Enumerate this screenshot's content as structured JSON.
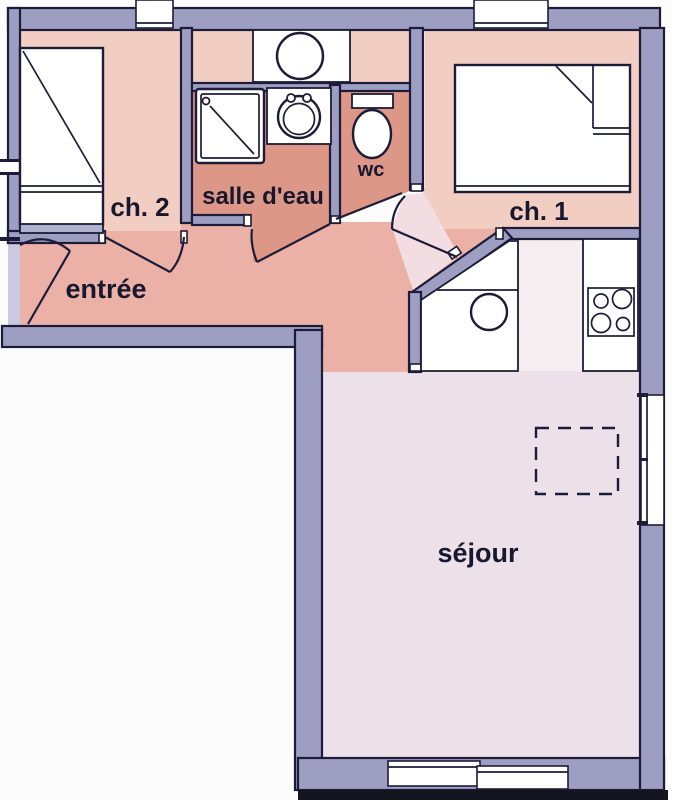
{
  "title": "Plan d'appartement (apartment floor plan)",
  "rooms": [
    {
      "id": "ch2",
      "label": "ch. 2"
    },
    {
      "id": "salle_deau",
      "label": "salle d'eau"
    },
    {
      "id": "wc",
      "label": "wc"
    },
    {
      "id": "ch1",
      "label": "ch. 1"
    },
    {
      "id": "entree",
      "label": "entrée"
    },
    {
      "id": "sejour",
      "label": "séjour"
    }
  ],
  "fixtures": [
    "single-bed",
    "double-bed",
    "shower",
    "washbasin",
    "round-appliance-counter",
    "toilet",
    "kitchen-sink",
    "cooktop-4-burners",
    "dashed-table-outline",
    "entry-door-swing",
    "bedroom2-door-swing",
    "bathroom-door-swing",
    "wc-door-swing",
    "bedroom1-door-swing",
    "window-right",
    "window-bottom",
    "duct-top-left",
    "duct-top-right"
  ],
  "colors": {
    "wall": "#9d9ec2",
    "outline": "#1c1c38",
    "bedroom": "#f2cec2",
    "wet": "#dd9787",
    "entree": "#ebb1a6",
    "sejour": "#ece1e8",
    "kitchen": "#f4eef1",
    "pale": "#f2dee2",
    "lavender": "#c9c9e0",
    "headboard": "#b0b2d0",
    "scanband": "#15151f"
  }
}
